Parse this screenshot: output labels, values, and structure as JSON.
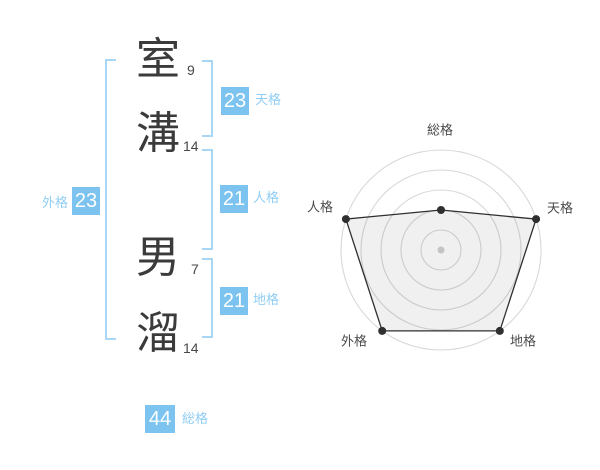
{
  "page": {
    "background": "#ffffff"
  },
  "colors": {
    "accent": "#7cc3f0",
    "label_blue": "#8fcdf4",
    "bracket": "#a8d7f5",
    "polygon_stroke": "#2f2f2f",
    "grid_ring": "#d8d8d8",
    "center_dot": "#c4c4c4"
  },
  "name_panel": {
    "characters": [
      {
        "char": "室",
        "strokes": "9"
      },
      {
        "char": "溝",
        "strokes": "14"
      },
      {
        "char": "男",
        "strokes": "7"
      },
      {
        "char": "溜",
        "strokes": "14"
      }
    ],
    "badges": {
      "tenkaku": {
        "value": "23",
        "label": "天格"
      },
      "jinkaku": {
        "value": "21",
        "label": "人格"
      },
      "chikaku": {
        "value": "21",
        "label": "地格"
      },
      "gaikaku": {
        "value": "23",
        "label": "外格"
      },
      "soukaku": {
        "value": "44",
        "label": "総格"
      }
    }
  },
  "chart_data": {
    "type": "radar",
    "axes": [
      "総格",
      "天格",
      "地格",
      "外格",
      "人格"
    ],
    "values": [
      44,
      23,
      21,
      23,
      21
    ],
    "radius_fractions": [
      0.4,
      1,
      1,
      1,
      1
    ],
    "rings": 5,
    "grid": "circular",
    "legend": "none"
  }
}
